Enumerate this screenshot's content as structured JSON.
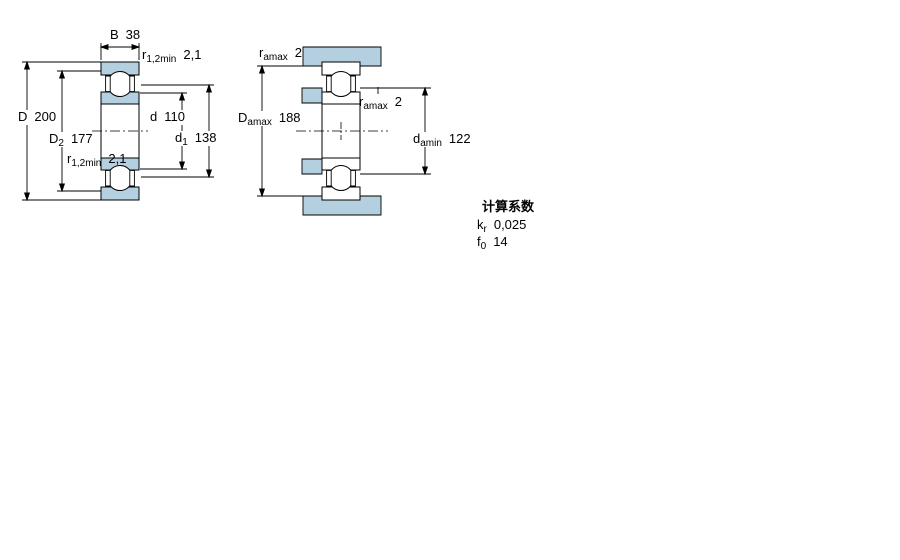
{
  "colors": {
    "bearing_fill": "#b4cfdf",
    "line": "#000000",
    "background": "#ffffff"
  },
  "left_figure": {
    "description": "bearing cross-section with boundary dimensions",
    "dims": {
      "B": {
        "symbol": "B",
        "sub": "",
        "value": "38"
      },
      "r12_top": {
        "symbol": "r",
        "sub": "1,2min",
        "value": "2,1"
      },
      "D": {
        "symbol": "D",
        "sub": "",
        "value": "200"
      },
      "D2": {
        "symbol": "D",
        "sub": "2",
        "value": "177"
      },
      "d": {
        "symbol": "d",
        "sub": "",
        "value": "110"
      },
      "d1": {
        "symbol": "d",
        "sub": "1",
        "value": "138"
      },
      "r12_bottom": {
        "symbol": "r",
        "sub": "1,2min",
        "value": "2,1"
      }
    }
  },
  "right_figure": {
    "description": "abutment and fillet dimensions (bearing mounted between shaft and housing shoulders)",
    "dims": {
      "ra_top": {
        "symbol": "r",
        "sub": "amax",
        "value": "2"
      },
      "Da": {
        "symbol": "D",
        "sub": "amax",
        "value": "188"
      },
      "ra_mid": {
        "symbol": "r",
        "sub": "amax",
        "value": "2"
      },
      "da": {
        "symbol": "d",
        "sub": "amin",
        "value": "122"
      }
    }
  },
  "calculation_factors": {
    "title": "计算系数",
    "rows": [
      {
        "symbol": "k",
        "sub": "r",
        "value": "0,025"
      },
      {
        "symbol": "f",
        "sub": "0",
        "value": "14"
      }
    ]
  }
}
